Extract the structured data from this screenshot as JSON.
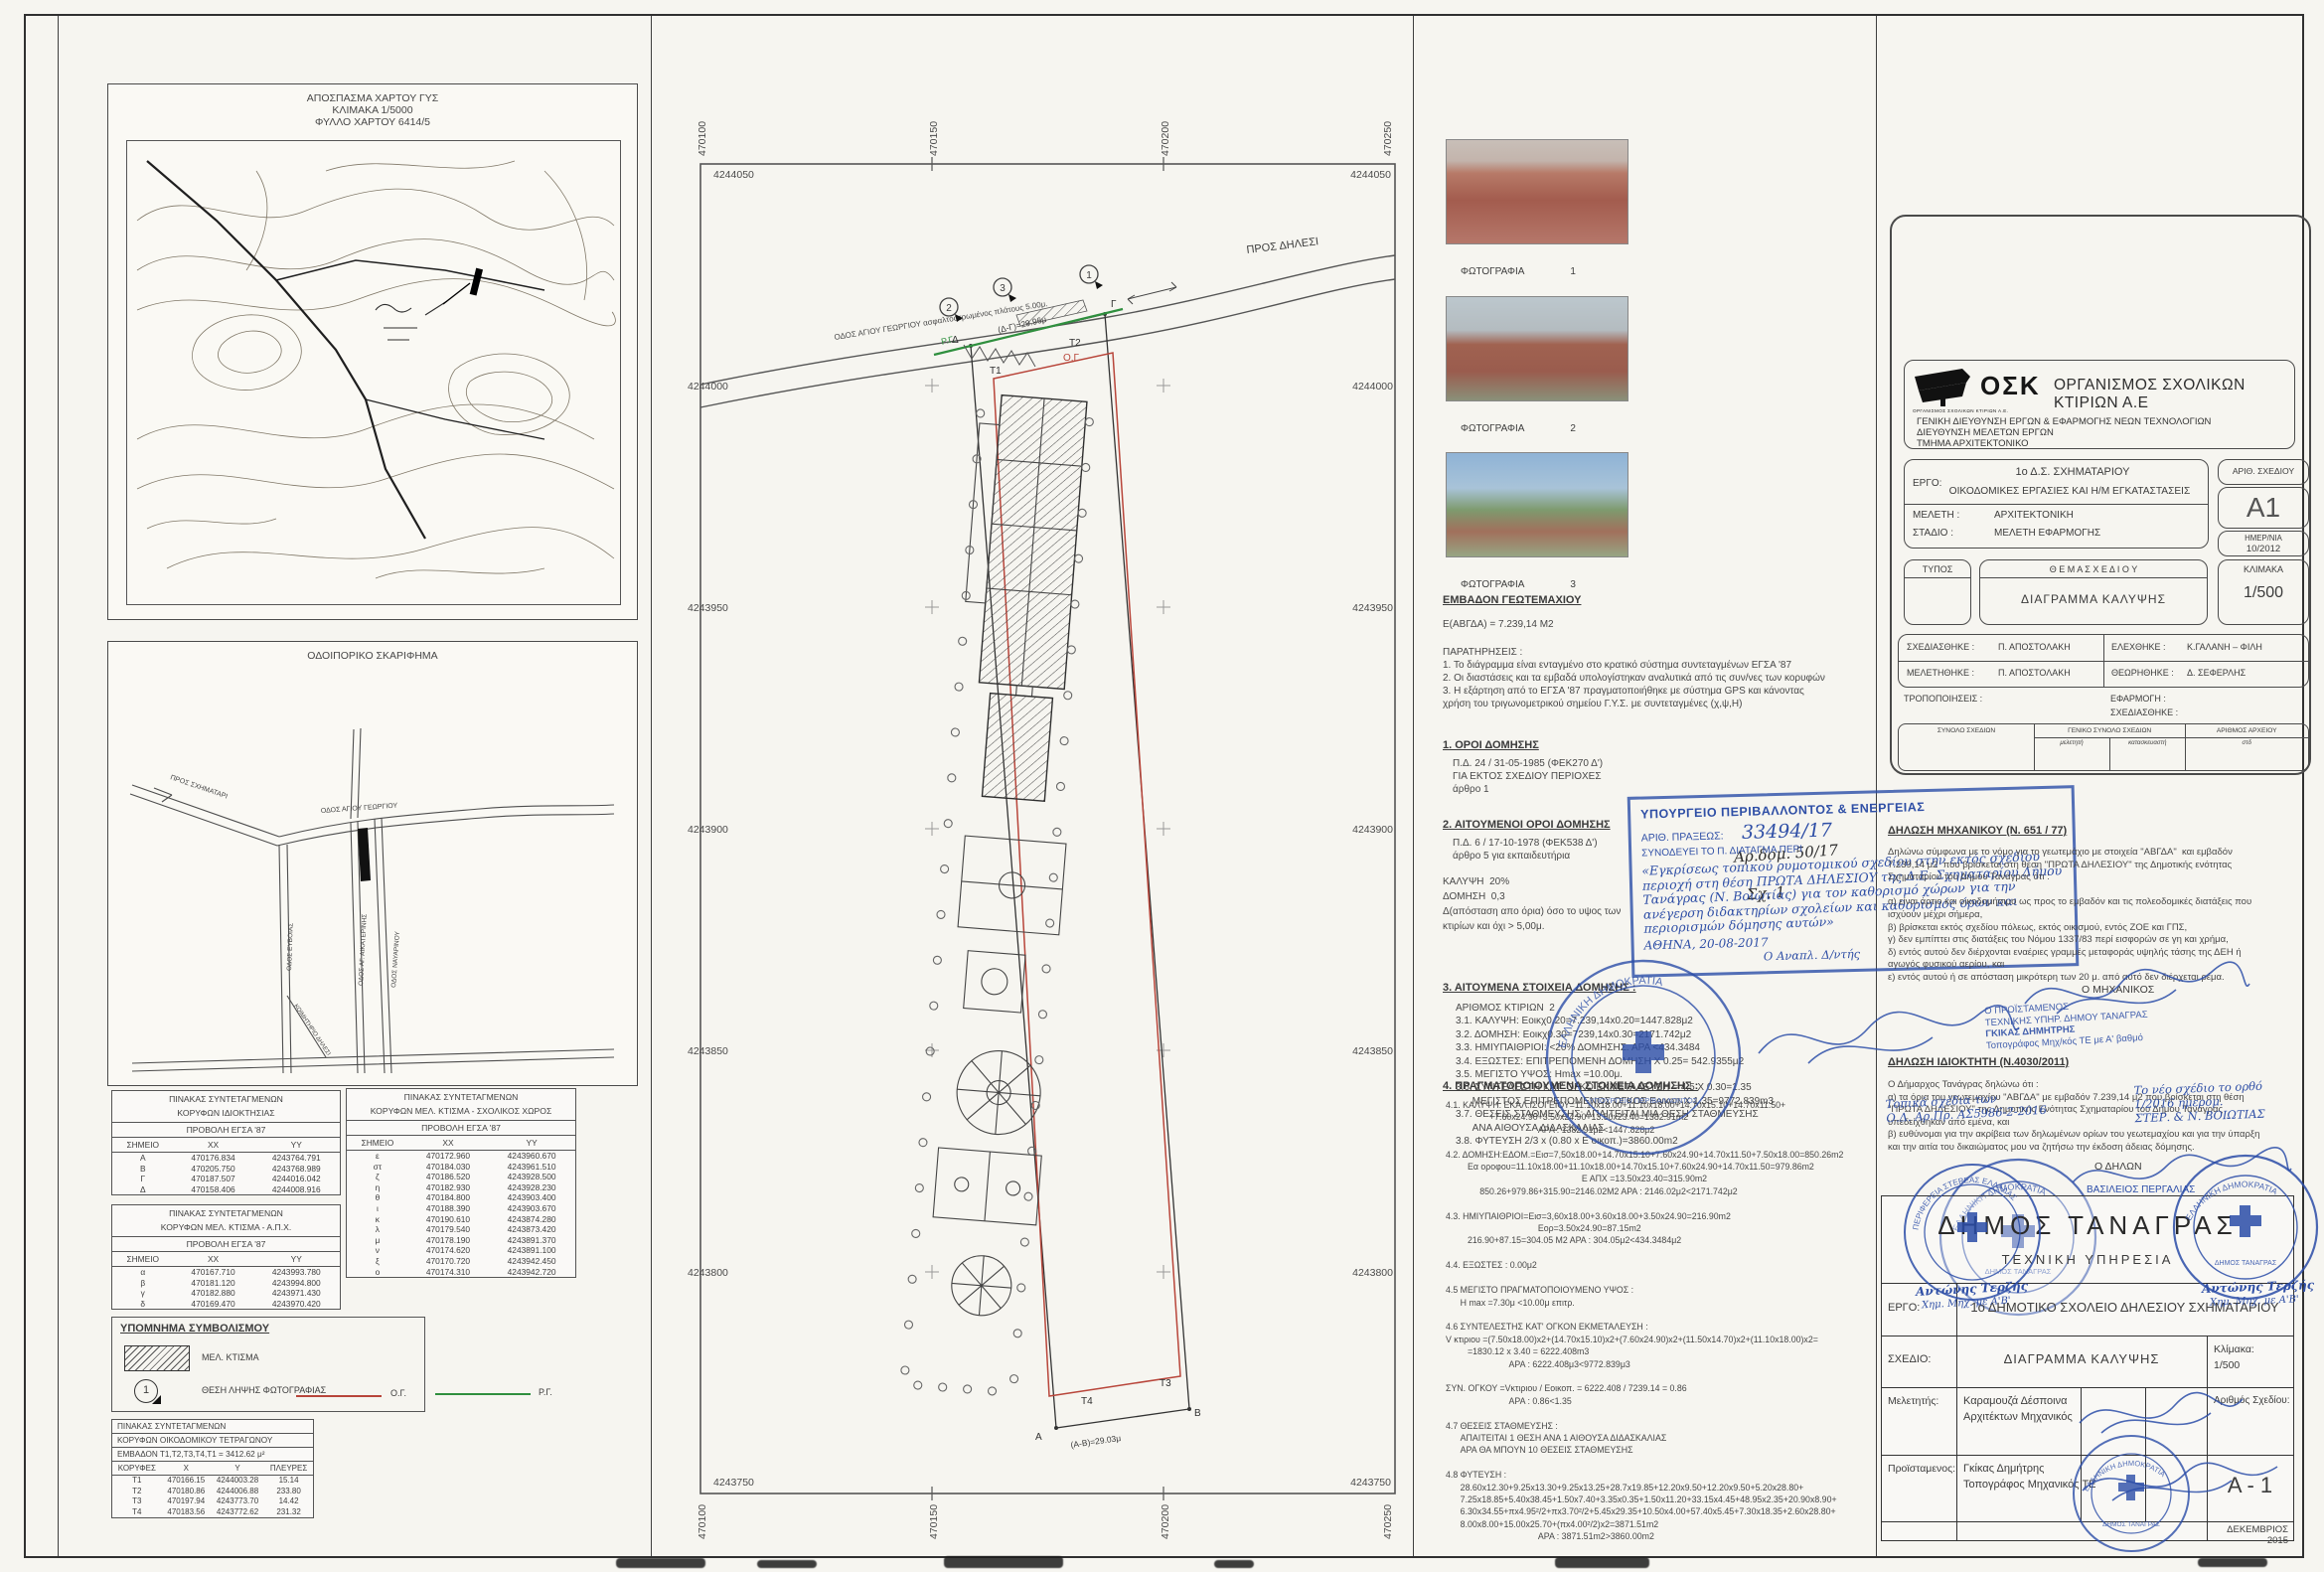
{
  "colors": {
    "accent_red": "#b8453a",
    "accent_green": "#2f8f3e",
    "stamp_blue": "#2b4da8",
    "ink": "#3c3c3c",
    "paper": "#f6f5f0"
  },
  "left": {
    "map": {
      "l1": "ΑΠΟΣΠΑΣΜΑ ΧΑΡΤΟΥ ΓΥΣ",
      "l2": "ΚΛΙΜΑΚΑ 1/5000",
      "l3": "ΦΥΛΛΟ ΧΑΡΤΟΥ 6414/5"
    },
    "sketch": {
      "title": "ΟΔΟΙΠΟΡΙΚΟ ΣΚΑΡΙΦΗΜΑ",
      "to_schimatari": "ΠΡΟΣ ΣΧΗΜΑΤΑΡΙ",
      "agiou_georgiou": "ΟΔΟΣ ΑΓΙΟΥ ΓΕΩΡΓΙΟΥ",
      "evias": "ΟΔΟΣ ΕΥΒΟΙΑΣ",
      "aikaterinis": "ΟΔΟΣ ΑΓ. ΑΙΚΑΤΕΡΙΝΗΣ",
      "navarinou": "ΟΔΟΣ ΝΑΥΑΡΙΝΟΥ",
      "cemetery": "ΚΟΙΜΗΤΗΡΙΟ ΔΗΛΕΣΙ"
    },
    "t1": {
      "title1": "ΠΙΝΑΚΑΣ ΣΥΝΤΕΤΑΓΜΕΝΩΝ",
      "title2": "ΚΟΡΥΦΩΝ ΙΔΙΟΚΤΗΣΙΑΣ",
      "proj": "ΠΡΟΒΟΛΗ ΕΓΣΑ '87",
      "headers": [
        "ΣΗΜΕΙΟ",
        "XX",
        "YY"
      ],
      "rows": [
        [
          "Α",
          "470176.834",
          "4243764.791"
        ],
        [
          "Β",
          "470205.750",
          "4243768.989"
        ],
        [
          "Γ",
          "470187.507",
          "4244016.042"
        ],
        [
          "Δ",
          "470158.406",
          "4244008.916"
        ]
      ]
    },
    "t2": {
      "title1": "ΠΙΝΑΚΑΣ ΣΥΝΤΕΤΑΓΜΕΝΩΝ",
      "title2": "ΚΟΡΥΦΩΝ ΜΕΛ. ΚΤΙΣΜΑ - ΣΧΟΛΙΚΟΣ ΧΩΡΟΣ",
      "proj": "ΠΡΟΒΟΛΗ ΕΓΣΑ '87",
      "headers": [
        "ΣΗΜΕΙΟ",
        "XX",
        "YY"
      ],
      "rows": [
        [
          "ε",
          "470172.960",
          "4243960.670"
        ],
        [
          "στ",
          "470184.030",
          "4243961.510"
        ],
        [
          "ζ",
          "470186.520",
          "4243928.500"
        ],
        [
          "η",
          "470182.930",
          "4243928.230"
        ],
        [
          "θ",
          "470184.800",
          "4243903.400"
        ],
        [
          "ι",
          "470188.390",
          "4243903.670"
        ],
        [
          "κ",
          "470190.610",
          "4243874.280"
        ],
        [
          "λ",
          "470179.540",
          "4243873.420"
        ],
        [
          "μ",
          "470178.190",
          "4243891.370"
        ],
        [
          "ν",
          "470174.620",
          "4243891.100"
        ],
        [
          "ξ",
          "470170.720",
          "4243942.450"
        ],
        [
          "ο",
          "470174.310",
          "4243942.720"
        ]
      ]
    },
    "t3": {
      "title1": "ΠΙΝΑΚΑΣ ΣΥΝΤΕΤΑΓΜΕΝΩΝ",
      "title2": "ΚΟΡΥΦΩΝ ΜΕΛ. ΚΤΙΣΜΑ - Α.Π.Χ.",
      "proj": "ΠΡΟΒΟΛΗ ΕΓΣΑ '87",
      "headers": [
        "ΣΗΜΕΙΟ",
        "XX",
        "YY"
      ],
      "rows": [
        [
          "α",
          "470167.710",
          "4243993.780"
        ],
        [
          "β",
          "470181.120",
          "4243994.800"
        ],
        [
          "γ",
          "470182.880",
          "4243971.430"
        ],
        [
          "δ",
          "470169.470",
          "4243970.420"
        ]
      ]
    },
    "legend": {
      "title": "ΥΠΟΜΝΗΜΑ ΣΥΜΒΟΛΙΣΜΟΥ",
      "mel": "ΜΕΛ. ΚΤΙΣΜΑ",
      "num": "1",
      "photo": "ΘΕΣΗ ΛΗΨΗΣ ΦΩΤΟΓΡΑΦΙΑΣ",
      "og": "Ο.Γ.",
      "rg": "Ρ.Γ."
    },
    "tot": {
      "t": "ΠΙΝΑΚΑΣ ΣΥΝΤΕΤΑΓΜΕΝΩΝ",
      "sub": "ΚΟΡΥΦΩΝ ΟΙΚΟΔΟΜΙΚΟΥ ΤΕΤΡΑΓΩΝΟΥ",
      "area": "ΕΜΒΑΔΟΝ Τ1,Τ2,Τ3,Τ4,Τ1 = 3412.62 μ²",
      "headers": [
        "ΚΟΡΥΦΕΣ",
        "X",
        "Y",
        "ΠΛΕΥΡΕΣ"
      ],
      "rows": [
        [
          "Τ1",
          "470166.15",
          "4244003.28",
          "15.14"
        ],
        [
          "Τ2",
          "470180.86",
          "4244006.88",
          "233.80"
        ],
        [
          "Τ3",
          "470197.94",
          "4243773.70",
          "14.42"
        ],
        [
          "Τ4",
          "470183.56",
          "4243772.62",
          "231.32"
        ]
      ]
    }
  },
  "plan": {
    "gx": [
      "470100",
      "470150",
      "470200",
      "470250"
    ],
    "top_y": "4244050",
    "bottom_y": "4243750",
    "gy": [
      "4244000",
      "4243950",
      "4243900",
      "4243850",
      "4243800"
    ],
    "road": "ΟΔΟΣ ΑΓΙΟΥ ΓΕΩΡΓΙΟΥ ασφαλτοστρωμένος πλάτους 5.00μ.",
    "dilesi": "ΠΡΟΣ ΔΗΛΕΣΙ",
    "dim_top": "(Δ-Γ)=29.96μ",
    "dim_bottom": "(Α-Β)=29.03μ",
    "rg": "Ρ.Γ.",
    "og": "Ο.Γ.",
    "pA": "Α",
    "pB": "Β",
    "pC": "Γ",
    "pD": "Δ",
    "t1": "Τ1",
    "t2": "Τ2",
    "t3": "Τ3",
    "t4": "Τ4",
    "ph": [
      "1",
      "2",
      "3"
    ]
  },
  "photos": {
    "items": [
      {
        "label": "ΦΩΤΟΓΡΑΦΙΑ",
        "num": "1"
      },
      {
        "label": "ΦΩΤΟΓΡΑΦΙΑ",
        "num": "2"
      },
      {
        "label": "ΦΩΤΟΓΡΑΦΙΑ",
        "num": "3"
      }
    ]
  },
  "notes": {
    "em_t": "ΕΜΒΑΔΟΝ ΓΕΩΤΕΜΑΧΙΟΥ",
    "em_v": "Ε(ΑΒΓΔΑ) = 7.239,14 Μ2",
    "par": "ΠΑΡΑΤΗΡΗΣΕΙΣ :\n1. Το διάγραμμα είναι ενταγμένο στο κρατικό σύστημα συντεταγμένων ΕΓΣΑ '87\n2. Οι διαστάσεις και τα εμβαδά υπολογίστηκαν αναλυτικά από τις συν/νες των κορυφών\n3. Η εξάρτηση από το ΕΓΣΑ '87 πραγματοποιήθηκε με σύστημα GPS και κάνοντας\nχρήση του τριγωνομετρικού σημείου Γ.Υ.Σ. με συντεταγμένες (χ,ψ,Η)",
    "s1t": "1. ΟΡΟΙ ΔΟΜΗΣΗΣ",
    "s1b": "Π.Δ. 24 / 31-05-1985 (ΦΕΚ270 Δ')\nΓΙΑ ΕΚΤΟΣ ΣΧΕΔΙΟΥ ΠΕΡΙΟΧΕΣ\nάρθρο 1",
    "s2t": "2. ΑΙΤΟΥΜΕΝΟΙ ΟΡΟΙ ΔΟΜΗΣΗΣ",
    "s2b": "Π.Δ. 6 / 17-10-1978 (ΦΕΚ538 Δ')\nάρθρο 5 για εκπαιδευτήρια",
    "s2c": "ΚΑΛΥΨΗ  20%\nΔΟΜΗΣΗ  0,3\nΔ(απόσταση απο όρια) όσο το υψος των\nκτιρίων και όχι > 5,00μ.",
    "hand1": "Αρ.δομ. 50/17",
    "hand2": "Σχ. 1",
    "s3t": "3. ΑΙΤΟΥΜΕΝΑ ΣΤΟΙΧΕΙΑ ΔΟΜΗΣΗΣ :",
    "s3b": "ΑΡΙΘΜΟΣ ΚΤΙΡΙΩΝ  2\n3.1. ΚΑΛΥΨΗ: Εοικχ0.20=7.239,14x0.20=1447.828μ2\n3.2. ΔΟΜΗΣΗ: Εοικχ0.30=7239,14x0.30=2171.742μ2\n3.3. ΗΜΙΥΠΑΙΘΡΙΟΙ: <20% ΔΟΜΗΣΗΣ. ΑΡΑ <434.3484\n3.4. ΕΞΩΣΤΕΣ: ΕΠΙΤΡΕΠΟΜΕΝΗ ΔΟΜΗΣΗ Χ 0.25= 542.9355μ2\n3.5. ΜΕΓΙΣΤΟ ΥΨΟΣ: Hmax =10.00μ.\n3.6. ΣΥΝΤΕΛΕΣΤΗ ΚΑΤ' ΟΓΚΟ ΕΚΜΕΤΑΛΕΥΣΗ = 4.5 Χ 0.30=1.35\n      ΜΕΓΙΣΤΟΣ ΕΠΙΤΡΕΠΟΜΕΝΟΣ ΟΓΚΟΣ Εοικοπ Χ 1.35=9772.839m3\n3.7. ΘΕΣΕΙΣ ΣΤΑΘΜΕΥΣΗΣ: ΑΠΑΙΤΕΙΤΑΙ ΜΙΑ ΘΕΣΗ ΣΤΑΘΜΕΥΣΗΣ\n      ΑΝΑ ΑΙΘΟΥΣΑ ΔΙΔΑΣΚΑΛΙΑΣ\n3.8. ΦΥΤΕΥΣΗ 2/3 x (0.80 x Ε οικοπ.)=3860.00m2",
    "s4t": "4. ΠΡΑΓΜΑΤΟΠΟΙΟΥΜΕΝΑ ΣΤΟΙΧΕΙΑ ΔΟΜΗΣΗΣ :",
    "s4b": "4.1. ΚΑΛΥΨΗ: ΕΚΑΛ.ΙΣΟΓΕΙΟΥ=11.10x18.00+11.10x18.00+14.70x15.10+14.70x11.50+\n                  +7.60x24.90+3.50x24.90+13.50x23.40=1382.91m2\n                                      ΑΡΑ : 1382.91μ2<1447.828μ2\n\n4.2. ΔΟΜΗΣΗ:ΕΔΟΜ.=Εισ=7,50x18.00+14.70x15.10+7.60x24.90+14.70x11.50+7.50x18.00=850.26m2\n         Εα οροφου=11.10x18.00+11.10x18.00+14.70x15.10+7.60x24.90+14.70x11.50=979.86m2\n                                                        Ε ΑΠΧ =13.50x23.40=315.90m2\n              850.26+979.86+315.90=2146.02Μ2 ΑΡΑ : 2146.02μ2<2171.742μ2\n\n4.3. ΗΜΙΥΠΑΙΘΡΙΟΙ=Εισ=3,60x18.00+3.60x18.00+3.50x24.90=216.90m2\n                                      Εορ=3.50x24.90=87.15m2\n         216.90+87.15=304.05 Μ2 ΑΡΑ : 304.05μ2<434.3484μ2\n\n4.4. ΕΞΩΣΤΕΣ : 0.00μ2\n\n4.5 ΜΕΓΙΣΤΟ ΠΡΑΓΜΑΤΟΠΟΙΟΥΜΕΝΟ ΥΨΟΣ :\n      Η max =7.30μ <10.00μ επιτρ.\n\n4.6 ΣΥΝΤΕΛΕΣΤΗΣ ΚΑΤ' ΟΓΚΟΝ ΕΚΜΕΤΑΛΕΥΣΗ :\nV κτιριου =(7.50x18.00)x2+(14.70x15.10)x2+(7.60x24.90)x2+(11.50x14.70)x2+(11.10x18.00)x2=\n         =1830.12 x 3.40 = 6222.408m3\n                          ΑΡΑ : 6222.408μ3<9772.839μ3\n\nΣΥΝ. ΟΓΚΟΥ =Vκτιριου / Εοικοπ. = 6222.408 / 7239.14 = 0.86\n                          ΑΡΑ : 0.86<1.35\n\n4.7 ΘΕΣΕΙΣ ΣΤΑΘΜΕΥΣΗΣ :\n      ΑΠΑΙΤΕΙΤΑΙ 1 ΘΕΣΗ ΑΝΑ 1 ΑΙΘΟΥΣΑ ΔΙΔΑΣΚΑΛΙΑΣ\n      ΑΡΑ ΘΑ ΜΠΟΥΝ 10 ΘΕΣΕΙΣ ΣΤΑΘΜΕΥΣΗΣ\n\n4.8 ΦΥΤΕΥΣΗ :\n      28.60x12.30+9.25x13.30+9.25x13.25+28.7x19.85+12.20x9.50+12.20x9.50+5.20x28.80+\n      7.25x18.85+5.40x38.45+1.50x7.40+3.35x0.35+1.50x11.20+33.15x4.45+48.95x2.35+20.90x8.90+\n      6.30x34.55+πx4.95²/2+πx3.70²/2+5.45x29.35+10.50x4.00+57.40x5.45+7.30x18.35+2.60x28.80+\n      8.00x8.00+15.00x25.70+(πx4.00²/2)x2=3871.51m2\n                                      ΑΡΑ : 3871.51m2>3860.00m2"
  },
  "minstamp": {
    "l1": "ΥΠΟΥΡΓΕΙΟ ΠΕΡΙΒΑΛΛΟΝΤΟΣ & ΕΝΕΡΓΕΙΑΣ",
    "l2_label": "ΑΡΙΘ. ΠΡΑΞΕΩΣ:",
    "l2_num": "33494/17",
    "l3": "ΣΥΝΟΔΕΥΕΙ ΤΟ Π. ΔΙΑΤΑΓΜΑ ΠΕΡΙ",
    "hand": "«Εγκρίσεως τοπικού ρυμοτομικού σχεδίου στην εκτός σχεδίου περιοχή στη θέση ΠΡΩΤΑ ΔΗΛΕΣΙΟΥ της Δ.Ε. Σχηματαρίου Δήμου Τανάγρας (Ν. Βοιωτίας) για τον καθορισμό χώρων για την ανέγερση διδακτηρίων σχολείων και καθορισμός όρων και περιορισμών δόμησης αυτών»",
    "date": "ΑΘΗΝΑ, 20-08-2017",
    "signer": "Ο Αναπλ. Δ/ντής"
  },
  "roundstamp": {
    "top": "ΕΛΛΗΝΙΚΗ ΔΗΜΟΚΡΑΤΙΑ",
    "bottom": "ΥΠΟΥΡΓΕΙΟ ΠΕΡΙΒΑΛΛΟΝΤΟΣ"
  },
  "osk": {
    "logo": "ΟΣΚ",
    "logo_caption": "ΟΡΓΑΝΙΣΜΟΣ ΣΧΟΛΙΚΩΝ ΚΤΙΡΙΩΝ Α.Ε.",
    "name_big": "ΟΡΓΑΝΙΣΜΟΣ ΣΧΟΛΙΚΩΝ ΚΤΙΡΙΩΝ Α.Ε",
    "d1": "ΓΕΝΙΚΗ ΔΙΕΥΘΥΝΣΗ ΕΡΓΩΝ & ΕΦΑΡΜΟΓΗΣ ΝΕΩΝ ΤΕΧΝΟΛΟΓΙΩΝ",
    "d2": "ΔΙΕΥΘΥΝΣΗ ΜΕΛΕΤΩΝ ΕΡΓΩΝ",
    "d3": "ΤΜΗΜΑ ΑΡΧΙΤΕΚΤΟΝΙΚΟ",
    "ergo_l": "ΕΡΓΟ:",
    "ergo1": "1ο Δ.Σ. ΣΧΗΜΑΤΑΡΙΟΥ",
    "ergo2": "ΟΙΚΟΔΟΜΙΚΕΣ ΕΡΓΑΣΙΕΣ ΚΑΙ Η/Μ ΕΓΚΑΤΑΣΤΑΣΕΙΣ",
    "mel_l": "ΜΕΛΕΤΗ :",
    "mel_v": "ΑΡΧΙΤΕΚΤΟΝΙΚΗ",
    "std_l": "ΣΤΑΔΙΟ :",
    "std_v": "ΜΕΛΕΤΗ ΕΦΑΡΜΟΓΗΣ",
    "arith_l": "ΑΡΙΘ. ΣΧΕΔΙΟΥ",
    "arith_v": "Α1",
    "date_l": "ΗΜΕΡ/ΝΙΑ",
    "date_v": "10/2012",
    "typos_l": "ΤΥΠΟΣ",
    "thema_l": "Θ Ε Μ Α   Σ Χ Ε Δ Ι Ο Υ",
    "thema_v": "ΔΙΑΓΡΑΜΜΑ  ΚΑΛΥΨΗΣ",
    "klim_l": "ΚΛΙΜΑΚΑ",
    "klim_v": "1/500",
    "r1l": "ΣΧΕΔΙΑΣΘΗΚΕ :",
    "r1v": "Π.  ΑΠΟΣΤΟΛΑΚΗ",
    "r2l": "ΕΛΕΧΘΗΚΕ :",
    "r2v": "Κ.ΓΑΛΑΝΗ – ΦΙΛΗ",
    "r3l": "ΜΕΛΕΤΗΘΗΚΕ :",
    "r3v": "Π.  ΑΠΟΣΤΟΛΑΚΗ",
    "r4l": "ΘΕΩΡΗΘΗΚΕ :",
    "r4v": "Δ. ΣΕΦΕΡΛΗΣ",
    "trop": "ΤΡΟΠΟΠΟΙΗΣΕΙΣ :",
    "efarm": "ΕΦΑΡΜΟΓΗ :",
    "sxed2": "ΣΧΕΔΙΑΣΘΗΚΕ :",
    "f1": "ΣΥΝΟΛΟ ΣΧΕΔΙΩΝ",
    "f2": "ΓΕΝΙΚΟ ΣΥΝΟΛΟ ΣΧΕΔΙΩΝ",
    "f2a": "μελετητή",
    "f2b": "κατασκευαστή",
    "f3": "ΑΡΙΘΜΟΣ ΑΡΧΕΙΟΥ",
    "f3a": "στδ"
  },
  "decl": {
    "mt": "ΔΗΛΩΣΗ  ΜΗΧΑΝΙΚΟΥ  (Ν. 651 / 77)",
    "mb": "Δηλώνω σύμφωνα με το νόμο για το γεωτεμάχιο με στοιχεία \"ΑΒΓΔΑ\"  και εμβαδόν\n7.239,14 μ2  που βρίσκεται στη θέση \"ΠΡΩΤΑ ΔΗΛΕΣΙΟΥ\" της Δημοτικής ενότητας\nΣχηματαρίου του Δήμου Τανάγρας ότι :\n\nα) είναι άρτιο και οικοδομήσιμο ως προς το εμβαδόν και τις πολεοδομικές διατάξεις που\nισχύουν μέχρι σήμερα,\nβ) βρίσκεται εκτός σχεδίου πόλεως, εκτός οικισμού, εντός ΖΟΕ και ΓΠΣ,\nγ) δεν εμπίπτει στις διατάξεις του Νόμου 1337/83 περί εισφορών σε γη και χρήμα,\nδ) εντός αυτού δεν διέρχονται εναέριες γραμμές μεταφοράς υψηλής τάσης της ΔΕΗ ή\nαγωγός φυσικού αερίου, και\nε) εντός αυτού ή σε απόσταση μικρότερη των 20 μ. από αυτό δεν διέρχεται ρέμα.",
    "msig": "Ο  ΜΗΧΑΝΙΚΟΣ",
    "proist1": "Ο ΠΡΟΪΣΤΑΜΕΝΟΣ",
    "proist2": "ΤΕΧΝΙΚΗΣ ΥΠΗΡ. ΔΗΜΟΥ ΤΑΝΑΓΡΑΣ",
    "proist3": "ΓΚΙΚΑΣ ΔΗΜΗΤΡΗΣ",
    "proist4": "Τοπογράφος Μηχ/κός ΤΕ με Α' βαθμό",
    "ot": "ΔΗΛΩΣΗ ΙΔΙΟΚΤΗΤΗ (Ν.4030/2011)",
    "ob": "Ο Δήμαρχος Τανάγρας δηλώνω ότι :\nα) τα όρια του γεωτεμαχίου \"ΑΒΓΔΑ\" με εμβαδόν 7.239,14 μ2 που βρίσκεται στη θέση\n\"ΠΡΩΤΑ ΔΗΛΕΣΙΟΥ\" της Δημοτικής Ενότητας Σχηματαρίου του Δήμου Τανάγρας\nυπεδείχθηκαν από εμένα, και\nβ) ευθύνομαι για την ακρίβεια των δηλωμένων ορίων του γεωτεμαχίου και για την ύπαρξη\nκαι την αιτία του δικαιώματος μου να ζητήσω την έκδοση άδειας δόμησης.",
    "osig": "Ο ΔΗΛΩΝ",
    "oname": "ΒΑΣΙΛΕΙΟΣ ΠΕΡΓΑΛΙΑΣ"
  },
  "muni": {
    "name": "ΔΗΜΟΣ  ΤΑΝΑΓΡΑΣ",
    "dept": "ΤΕΧΝΙΚΗ  ΥΠΗΡΕΣΙΑ",
    "ergo_l": "ΕΡΓΟ:",
    "ergo_v": "1ο ΔΗΜΟΤΙΚΟ ΣΧΟΛΕΙΟ ΔΗΛΕΣΙΟΥ ΣΧΗΜΑΤΑΡΙΟΥ",
    "sx_l": "ΣΧΕΔΙΟ:",
    "sx_v": "ΔΙΑΓΡΑΜΜΑ ΚΑΛΥΨΗΣ",
    "klim_l": "Κλίμακα:",
    "klim_v": "1/500",
    "mel_l": "Μελετητής:",
    "mel_n1": "Καραμουζά  Δέσποινα",
    "mel_n2": "Αρχιτέκτων  Μηχανικός",
    "ar_l": "Αριθμός Σχεδίου:",
    "pro_l": "Προϊσταμενος:",
    "pro_n1": "Γκίκας Δημήτρης",
    "pro_n2": "Τοπογράφος Μηχανικός ΤΕ",
    "anum": "Α - 1",
    "date": "ΔΕΚΕΜΒΡΙΟΣ  2015",
    "hand_left": "Τοπικά σχέδια των\nΟ.Δ. Αρ.Πρ. ΑΣ5986-2-2016",
    "hand_right": "Το νέο σχέδιο το ορθό\n1/2016 ημερομ.\nΣΤΕΡ. & Ν. ΒΟΙΩΤΙΑΣ",
    "stamp_perif": "ΠΕΡΙΦΕΡΕΙΑ ΣΤΕΡΕΑΣ ΕΛΛΑΔΑΣ",
    "stamp_elldim": "ΕΛΛΗΝΙΚΗ ΔΗΜΟΚΡΑΤΙΑ",
    "stamp_dimos": "ΔΗΜΟΣ ΤΑΝΑΓΡΑΣ",
    "terzis1": "Αντώνης Τερζής",
    "terzis2": "Χημ. Μηχ. με Α'Β'"
  }
}
